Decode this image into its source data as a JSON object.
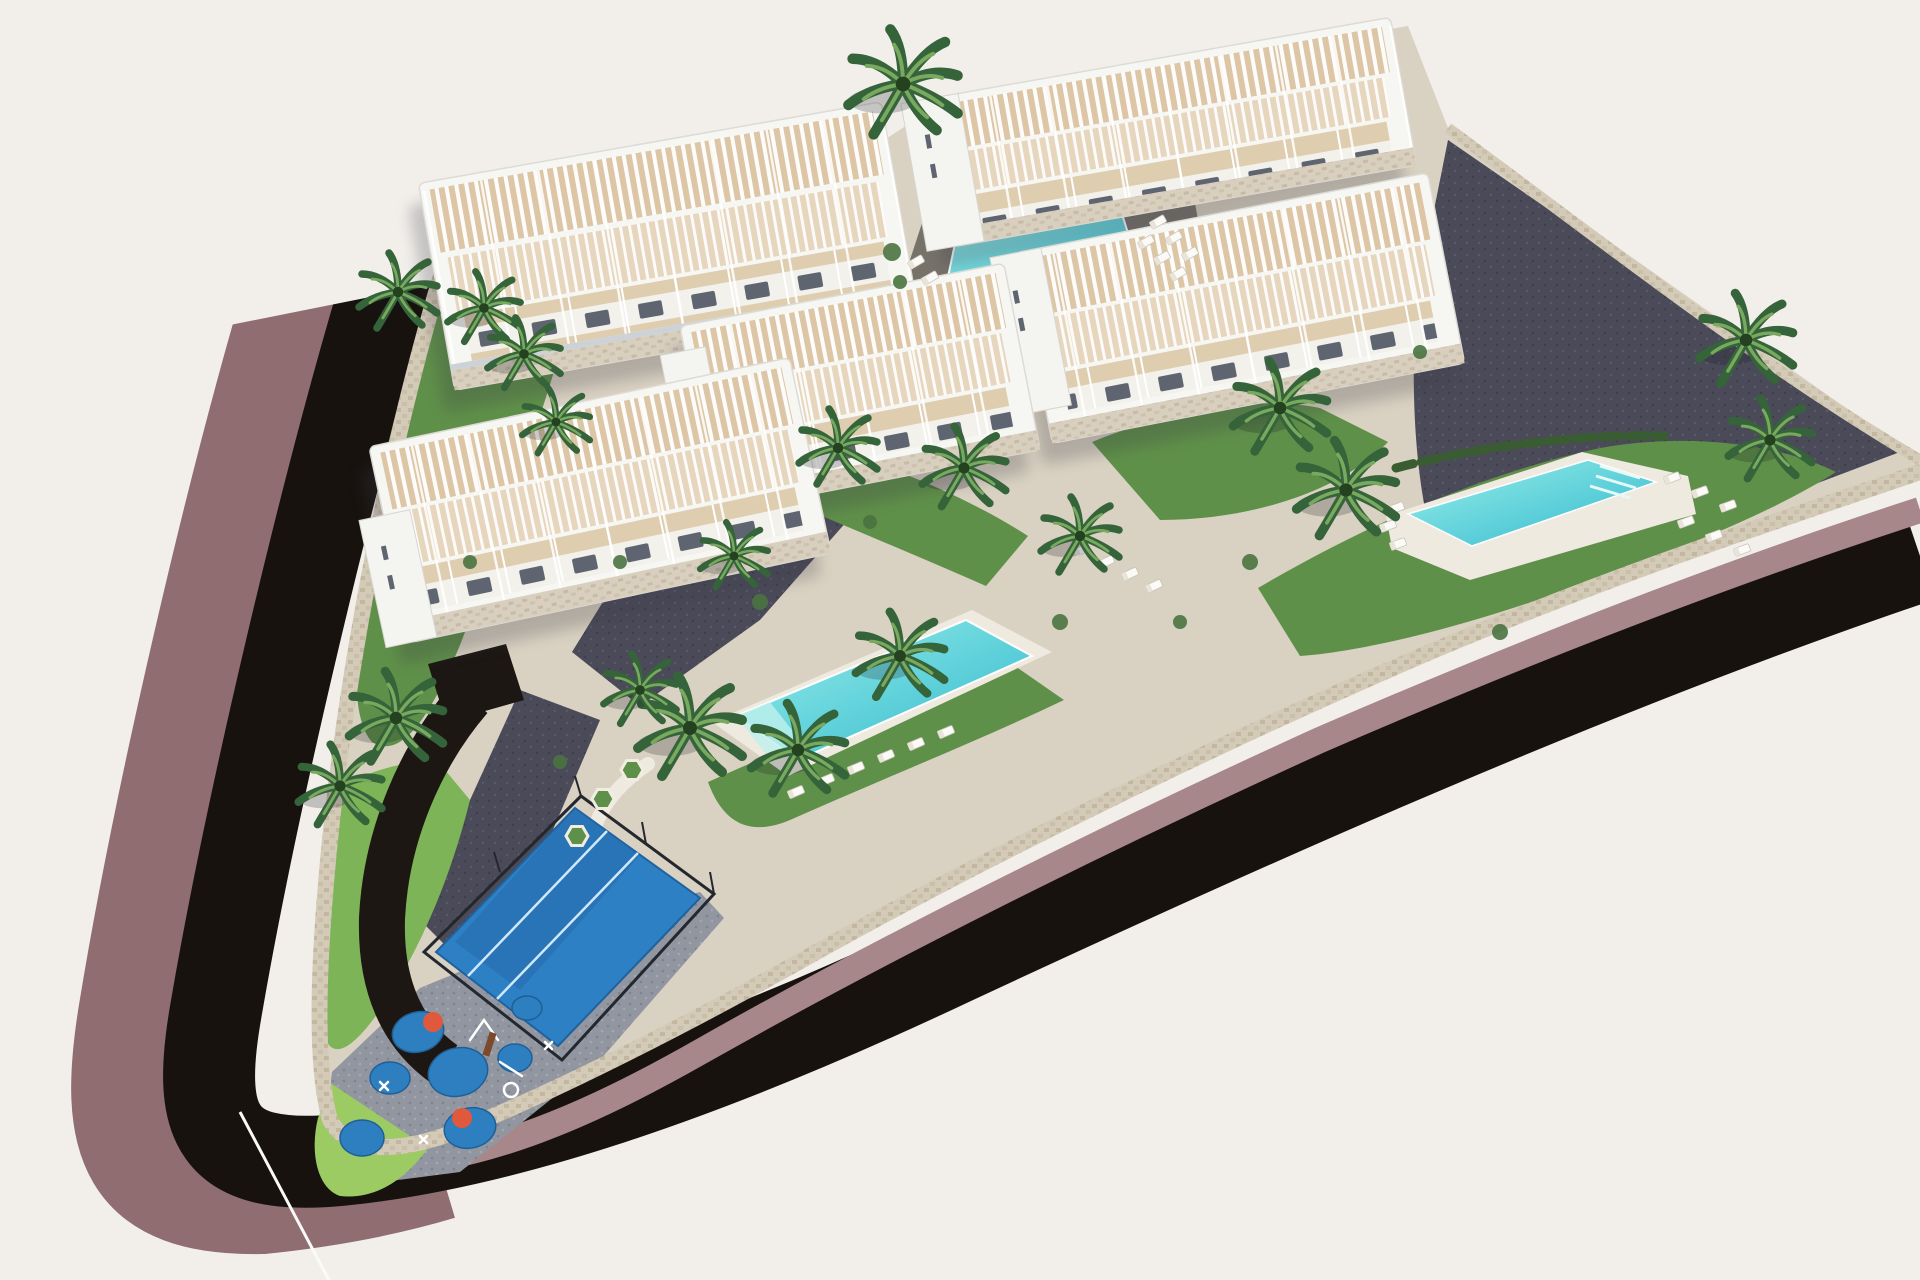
{
  "scene": {
    "title": "Aerial 3D architectural render of a residential complex: five white terraced apartment buildings with pergola roof terraces, three turquoise swimming pools, palm gardens, a padel court, a playground and a dark curving perimeter road with mauve sidewalks",
    "background": "#f2efeb",
    "colors": {
      "road_asphalt": "#17120e",
      "sidewalk_mauve": "#8f6d71",
      "sidewalk_mauve_light": "#a8878a",
      "stone_wall": "#d4cab8",
      "ground_stone": "#d9d1c1",
      "paver_dark": "#4b4a58",
      "paver_gray": "#9196a0",
      "lawn_green": "#5f9049",
      "lawn_bright": "#7cb457",
      "lawn_playground": "#9ccb63",
      "hedge_green": "#3a5c33",
      "palm_frond_dark": "#35633a",
      "palm_frond_light": "#79a95e",
      "pool_water_light": "#9af0ea",
      "pool_water_deep": "#2fb7cd",
      "pool_deck_dark": "#76726a",
      "pool_deck_white": "#efeadf",
      "building_white": "#f6f6f3",
      "building_trim": "#dddbd5",
      "terrace_beige": "#dcc6a6",
      "facade_shade": "#c9ced4",
      "window_dark": "#5f6570",
      "court_blue": "#2e80c4",
      "court_blue_dark": "#2569ab",
      "court_line": "#cfe8fa",
      "fence_dark": "#23272e",
      "play_blue": "#2e7fc0",
      "play_red": "#e0593c",
      "asphalt_drive": "#1c1713",
      "cable_white": "#fafaf8"
    },
    "counts": {
      "buildings": 5,
      "pools": 3,
      "padel_courts": 1,
      "playgrounds": 1
    },
    "palms": [
      {
        "x": 903,
        "y": 84,
        "s": 2.1
      },
      {
        "x": 398,
        "y": 292,
        "s": 1.5
      },
      {
        "x": 484,
        "y": 308,
        "s": 1.4
      },
      {
        "x": 524,
        "y": 354,
        "s": 1.4
      },
      {
        "x": 556,
        "y": 422,
        "s": 1.3
      },
      {
        "x": 1746,
        "y": 340,
        "s": 1.8
      },
      {
        "x": 1770,
        "y": 440,
        "s": 1.6
      },
      {
        "x": 1280,
        "y": 408,
        "s": 1.8
      },
      {
        "x": 1346,
        "y": 490,
        "s": 1.9
      },
      {
        "x": 1080,
        "y": 536,
        "s": 1.5
      },
      {
        "x": 838,
        "y": 448,
        "s": 1.5
      },
      {
        "x": 964,
        "y": 468,
        "s": 1.6
      },
      {
        "x": 734,
        "y": 556,
        "s": 1.3
      },
      {
        "x": 690,
        "y": 728,
        "s": 2.0
      },
      {
        "x": 798,
        "y": 750,
        "s": 1.8
      },
      {
        "x": 900,
        "y": 656,
        "s": 1.7
      },
      {
        "x": 396,
        "y": 718,
        "s": 1.8
      },
      {
        "x": 340,
        "y": 786,
        "s": 1.6
      },
      {
        "x": 640,
        "y": 690,
        "s": 1.4
      }
    ],
    "shrubs": [
      {
        "x": 892,
        "y": 252,
        "r": 9
      },
      {
        "x": 900,
        "y": 282,
        "r": 7
      },
      {
        "x": 1250,
        "y": 562,
        "r": 8
      },
      {
        "x": 1180,
        "y": 622,
        "r": 7
      },
      {
        "x": 1060,
        "y": 622,
        "r": 8
      },
      {
        "x": 870,
        "y": 522,
        "r": 7
      },
      {
        "x": 760,
        "y": 602,
        "r": 8
      },
      {
        "x": 620,
        "y": 562,
        "r": 7
      },
      {
        "x": 470,
        "y": 562,
        "r": 7
      },
      {
        "x": 1500,
        "y": 632,
        "r": 8
      },
      {
        "x": 560,
        "y": 762,
        "r": 7
      },
      {
        "x": 1420,
        "y": 352,
        "r": 7
      }
    ],
    "loungers": [
      {
        "x": 1158,
        "y": 222,
        "r": -30
      },
      {
        "x": 1174,
        "y": 238,
        "r": -30
      },
      {
        "x": 1190,
        "y": 254,
        "r": -30
      },
      {
        "x": 1146,
        "y": 242,
        "r": -30
      },
      {
        "x": 1162,
        "y": 258,
        "r": -30
      },
      {
        "x": 1178,
        "y": 274,
        "r": -30
      },
      {
        "x": 916,
        "y": 262,
        "r": -30
      },
      {
        "x": 930,
        "y": 278,
        "r": -30
      },
      {
        "x": 796,
        "y": 792,
        "r": -23
      },
      {
        "x": 826,
        "y": 780,
        "r": -23
      },
      {
        "x": 856,
        "y": 768,
        "r": -23
      },
      {
        "x": 886,
        "y": 756,
        "r": -23
      },
      {
        "x": 916,
        "y": 744,
        "r": -23
      },
      {
        "x": 946,
        "y": 732,
        "r": -23
      },
      {
        "x": 1672,
        "y": 478,
        "r": -20
      },
      {
        "x": 1700,
        "y": 492,
        "r": -20
      },
      {
        "x": 1728,
        "y": 506,
        "r": -20
      },
      {
        "x": 1686,
        "y": 522,
        "r": -20
      },
      {
        "x": 1714,
        "y": 536,
        "r": -20
      },
      {
        "x": 1742,
        "y": 550,
        "r": -20
      },
      {
        "x": 1396,
        "y": 508,
        "r": -20
      },
      {
        "x": 1388,
        "y": 526,
        "r": -20
      },
      {
        "x": 1398,
        "y": 544,
        "r": -20
      },
      {
        "x": 1082,
        "y": 550,
        "r": -25
      },
      {
        "x": 1106,
        "y": 562,
        "r": -25
      },
      {
        "x": 1130,
        "y": 574,
        "r": -25
      },
      {
        "x": 1154,
        "y": 586,
        "r": -25
      }
    ],
    "planters": [
      {
        "x": 603,
        "y": 799
      },
      {
        "x": 632,
        "y": 770
      },
      {
        "x": 577,
        "y": 836
      }
    ]
  }
}
